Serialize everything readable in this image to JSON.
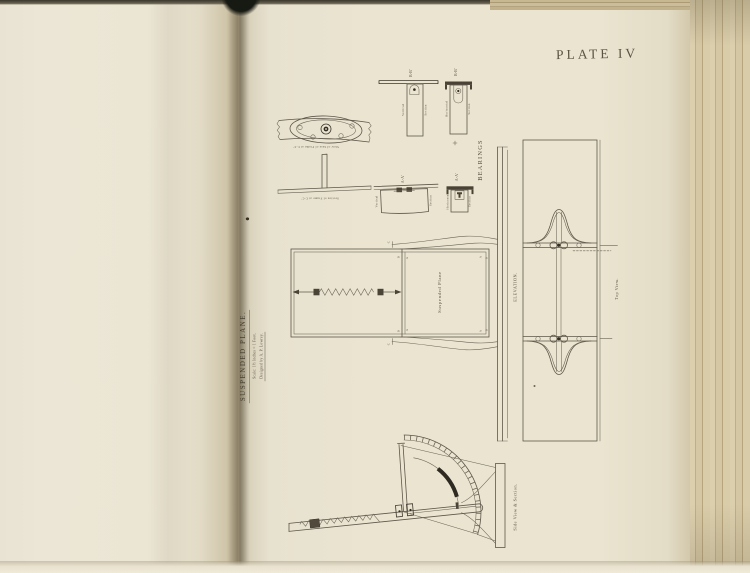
{
  "book": {
    "plate_number": "PLATE IV"
  },
  "title_block": {
    "title": "SUSPENDED PLANE.",
    "scale_line": "Scale: 1½ Inches = 1 Foot.",
    "credit_line": "Designed by A. P. Lowrey."
  },
  "detail_sections": {
    "view_base_label": "View of base of Frame at C-C'",
    "section_frame_label": "Section of Frame at C-C'",
    "bb_label": "B-B'",
    "aa_label": "A-A'",
    "vertical_label": "Vertical",
    "horizontal_label": "Horizontal",
    "section_label": "Section",
    "bearings_label": "BEARINGS"
  },
  "elevation": {
    "label": "ELEVATION.",
    "plane_label": "Suspended Plane",
    "letter_a": "A",
    "letter_b": "B",
    "letter_c": "C"
  },
  "top_view": {
    "label": "Top View."
  },
  "side_view": {
    "label": "Side View & Section."
  }
}
